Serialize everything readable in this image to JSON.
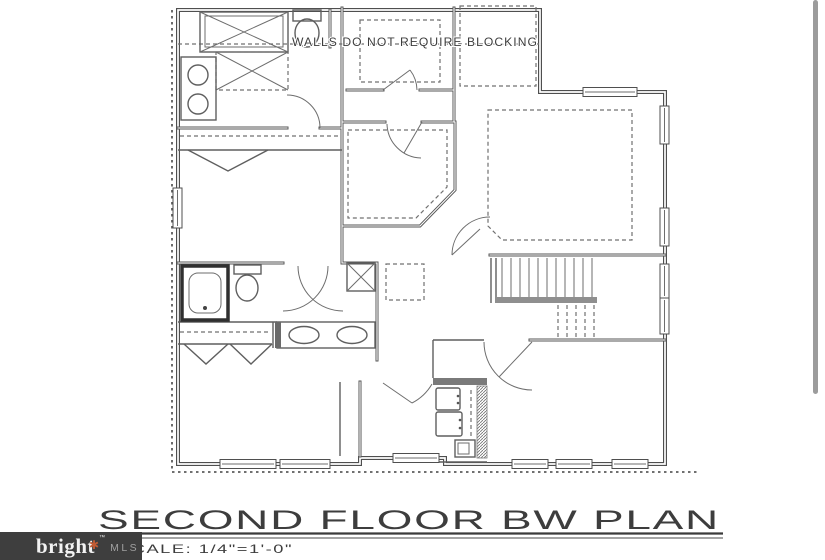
{
  "plan": {
    "blocking_note": "WALLS DO NOT REQUIRE BLOCKING",
    "title": "SECOND FLOOR BW PLAN",
    "scale_label": "SCALE: 1/4\"=1'-0\""
  },
  "watermark": {
    "brand": "bright",
    "asterisk": "✱",
    "trademark": "™",
    "mls": "MLS"
  },
  "colors": {
    "line": "#4f4f4f",
    "dash": "#707070",
    "background": "#ffffff",
    "watermark_bg": "#3e3e3e",
    "brand_white": "#f2f2f2",
    "brand_orange": "#c25b33",
    "mls_gray": "#a0a0a0",
    "scrollbar_gray": "#9c9c9c"
  }
}
